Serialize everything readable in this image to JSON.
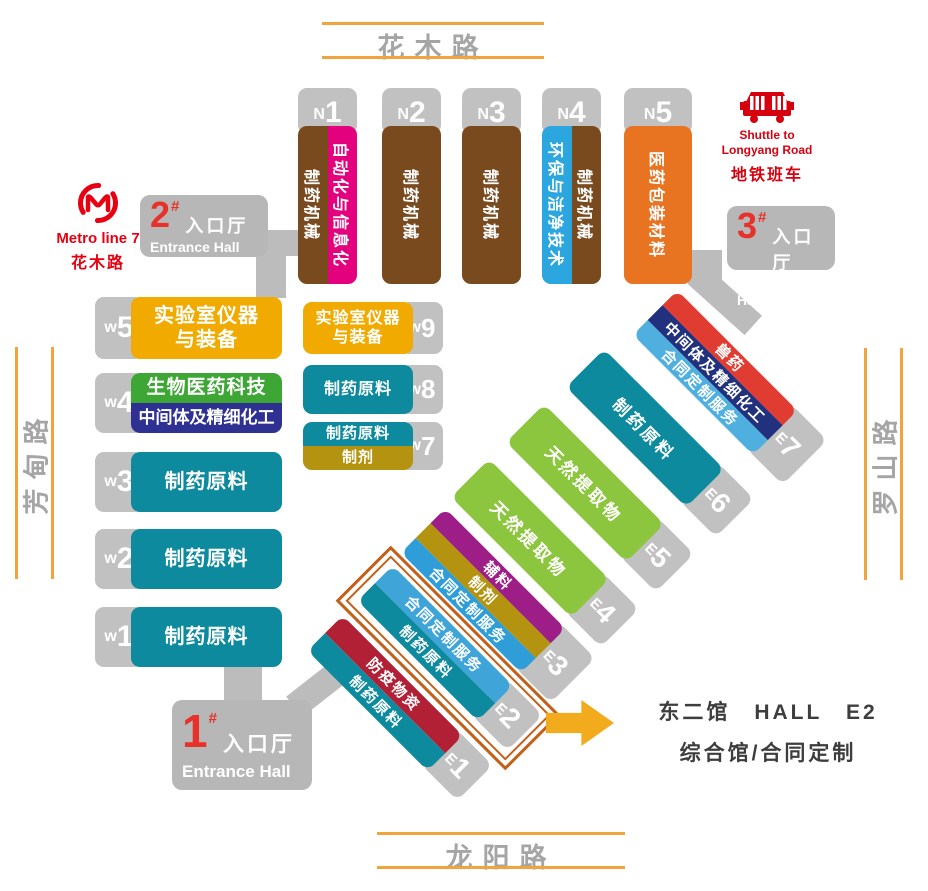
{
  "roads": {
    "top": "花木路",
    "bottom": "龙阳路",
    "left": "芳甸路",
    "right": "罗山路"
  },
  "metro": {
    "icon": "shanghai-metro-logo",
    "line": "Metro line 7",
    "station": "花木路",
    "color": "#e60012"
  },
  "shuttle": {
    "icon": "bus-icon",
    "en1": "Shuttle to",
    "en2": "Longyang Road",
    "cn": "地铁班车",
    "color": "#d7000f"
  },
  "entrances": {
    "e1": {
      "num": "1",
      "hash": "#",
      "cn": "入口厅",
      "en": "Entrance Hall"
    },
    "e2": {
      "num": "2",
      "hash": "#",
      "cn": "入口厅",
      "en": "Entrance Hall"
    },
    "e3": {
      "num": "3",
      "hash": "#",
      "cn": "入口厅",
      "en": "Entrance Hall"
    }
  },
  "north_halls": [
    {
      "letter": "N",
      "num": "1",
      "strips": [
        {
          "label": "制药机械",
          "color": "#7a4a1f"
        },
        {
          "label": "自动化与信息化",
          "color": "#e4017e"
        }
      ]
    },
    {
      "letter": "N",
      "num": "2",
      "strips": [
        {
          "label": "制药机械",
          "color": "#7a4a1f"
        }
      ]
    },
    {
      "letter": "N",
      "num": "3",
      "strips": [
        {
          "label": "制药机械",
          "color": "#7a4a1f"
        }
      ]
    },
    {
      "letter": "N",
      "num": "4",
      "strips": [
        {
          "label": "环保与洁净技术",
          "color": "#2ca6de"
        },
        {
          "label": "制药机械",
          "color": "#7a4a1f"
        }
      ]
    },
    {
      "letter": "N",
      "num": "5",
      "strips": [
        {
          "label": "医药包装材料",
          "color": "#e87422"
        }
      ]
    }
  ],
  "west_halls": [
    {
      "letter": "w",
      "num": "5",
      "rows": [
        {
          "label": "实验室仪器\n与装备",
          "color": "#f0aa00"
        }
      ]
    },
    {
      "letter": "w",
      "num": "4",
      "rows": [
        {
          "label": "生物医药科技",
          "color": "#3ea635"
        },
        {
          "label": "中间体及精细化工",
          "color": "#2e3192"
        }
      ]
    },
    {
      "letter": "w",
      "num": "3",
      "rows": [
        {
          "label": "制药原料",
          "color": "#0d8a9d"
        }
      ]
    },
    {
      "letter": "w",
      "num": "2",
      "rows": [
        {
          "label": "制药原料",
          "color": "#0d8a9d"
        }
      ]
    },
    {
      "letter": "w",
      "num": "1",
      "rows": [
        {
          "label": "制药原料",
          "color": "#0d8a9d"
        }
      ]
    }
  ],
  "west_small_halls": [
    {
      "letter": "w",
      "num": "9",
      "rows": [
        {
          "label": "实验室仪器\n与装备",
          "color": "#f0aa00"
        }
      ]
    },
    {
      "letter": "w",
      "num": "8",
      "rows": [
        {
          "label": "制药原料",
          "color": "#0d8a9d"
        }
      ]
    },
    {
      "letter": "w",
      "num": "7",
      "rows": [
        {
          "label": "制药原料",
          "color": "#0d8a9d"
        },
        {
          "label": "制剂",
          "color": "#b3930f"
        }
      ]
    }
  ],
  "east_halls": [
    {
      "letter": "E",
      "num": "1",
      "strips": [
        {
          "label": "防疫物资",
          "color": "#b12035"
        },
        {
          "label": "制药原料",
          "color": "#0d8a9d"
        }
      ]
    },
    {
      "letter": "E",
      "num": "2",
      "strips": [
        {
          "label": "合同定制服务",
          "color": "#3fa5d8"
        },
        {
          "label": "制药原料",
          "color": "#0d8a9d"
        }
      ]
    },
    {
      "letter": "E",
      "num": "3",
      "strips": [
        {
          "label": "辅料",
          "color": "#9c1e86"
        },
        {
          "label": "制剂",
          "color": "#b3930f"
        },
        {
          "label": "合同定制服务",
          "color": "#2f9ed8"
        }
      ]
    },
    {
      "letter": "E",
      "num": "4",
      "strips": [
        {
          "label": "天然提取物",
          "color": "#8cc63e"
        }
      ]
    },
    {
      "letter": "E",
      "num": "5",
      "strips": [
        {
          "label": "天然提取物",
          "color": "#8cc63e"
        }
      ]
    },
    {
      "letter": "E",
      "num": "6",
      "strips": [
        {
          "label": "制药原料",
          "color": "#0d8a9d"
        }
      ]
    },
    {
      "letter": "E",
      "num": "7",
      "strips": [
        {
          "label": "兽药",
          "color": "#e03c31"
        },
        {
          "label": "中间体及精细化工",
          "color": "#21317e"
        },
        {
          "label": "合同定制服务",
          "color": "#4fb0e0"
        }
      ]
    }
  ],
  "callout": {
    "line1": "东二馆　HALL　E2",
    "line2": "综合馆/合同定制",
    "frame_color": "#c35f17",
    "arrow_color": "#f2ab1c"
  }
}
